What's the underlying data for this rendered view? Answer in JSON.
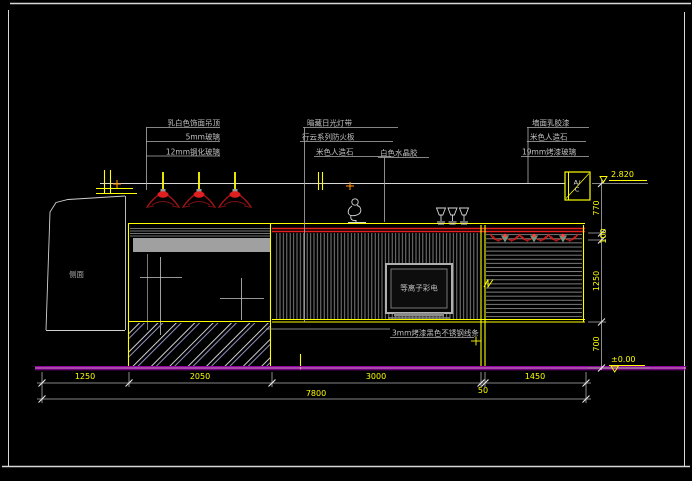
{
  "drawing": {
    "callouts_left": [
      "乳白色饰面吊顶",
      "5mm玻璃",
      "12mm钢化玻璃"
    ],
    "callouts_mid": [
      "暗藏日光灯带",
      "行云系列防火板",
      "米色人造石",
      "白色水晶胶"
    ],
    "callouts_right": [
      "墙面乳胶漆",
      "米色人造石",
      "19mm烤漆玻璃"
    ],
    "callout_strip": "3mm烤漆黑色不锈钢线条",
    "tv_label": "等离子彩电",
    "wall_label": "侧面",
    "ac_label": "A/\nC",
    "dims_bottom": [
      "1250",
      "2050",
      "3000",
      "1450"
    ],
    "dim_gap": "50",
    "dim_total": "7800",
    "dims_right": [
      "770",
      "100",
      "1250",
      "700"
    ],
    "elev_top": "2.820",
    "elev_floor": "±0.00",
    "colors": {
      "line_yellow": "#ffff00",
      "line_red": "#e82020",
      "floor_magenta": "#b000b0",
      "annotation_gray": "#c0c0c0",
      "background": "#000000"
    }
  }
}
